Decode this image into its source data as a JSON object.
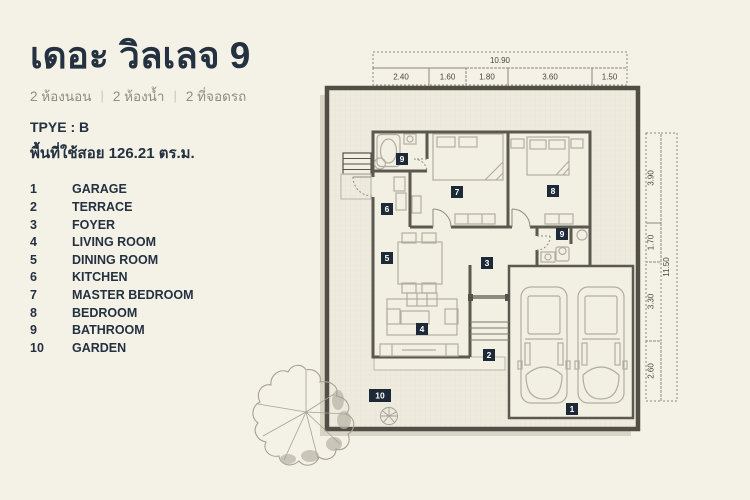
{
  "header": {
    "title": "เดอะ วิลเลจ 9",
    "subtitle_items": [
      "2 ห้องนอน",
      "2 ห้องน้ำ",
      "2 ที่จอดรถ"
    ],
    "type_label": "TPYE : B",
    "area_label": "พื้นที่ใช้สอย 126.21 ตร.ม."
  },
  "legend": {
    "items": [
      {
        "num": "1",
        "name": "GARAGE"
      },
      {
        "num": "2",
        "name": "TERRACE"
      },
      {
        "num": "3",
        "name": "FOYER"
      },
      {
        "num": "4",
        "name": "LIVING ROOM"
      },
      {
        "num": "5",
        "name": "DINING ROOM"
      },
      {
        "num": "6",
        "name": "KITCHEN"
      },
      {
        "num": "7",
        "name": "MASTER BEDROOM"
      },
      {
        "num": "8",
        "name": "BEDROOM"
      },
      {
        "num": "9",
        "name": "BATHROOM"
      },
      {
        "num": "10",
        "name": "GARDEN"
      }
    ]
  },
  "plan": {
    "dims_top": {
      "total": "10.90",
      "segments": [
        "2.40",
        "1.60",
        "1.80",
        "3.60",
        "1.50"
      ]
    },
    "dims_right": {
      "total": "11.50",
      "segments": [
        "3.90",
        "1.70",
        "3.30",
        "2.60"
      ]
    }
  },
  "colors": {
    "background": "#f4f1e6",
    "accent_navy": "#243140",
    "marker_bg": "#1d2937",
    "wall_dark": "#55524a",
    "furniture_line": "#b2ae9f",
    "subtitle_gray": "#8f8d81",
    "yard_fill": "#eeebde",
    "room_fill": "#f2efe3",
    "shadow": "#d8d5c7"
  }
}
